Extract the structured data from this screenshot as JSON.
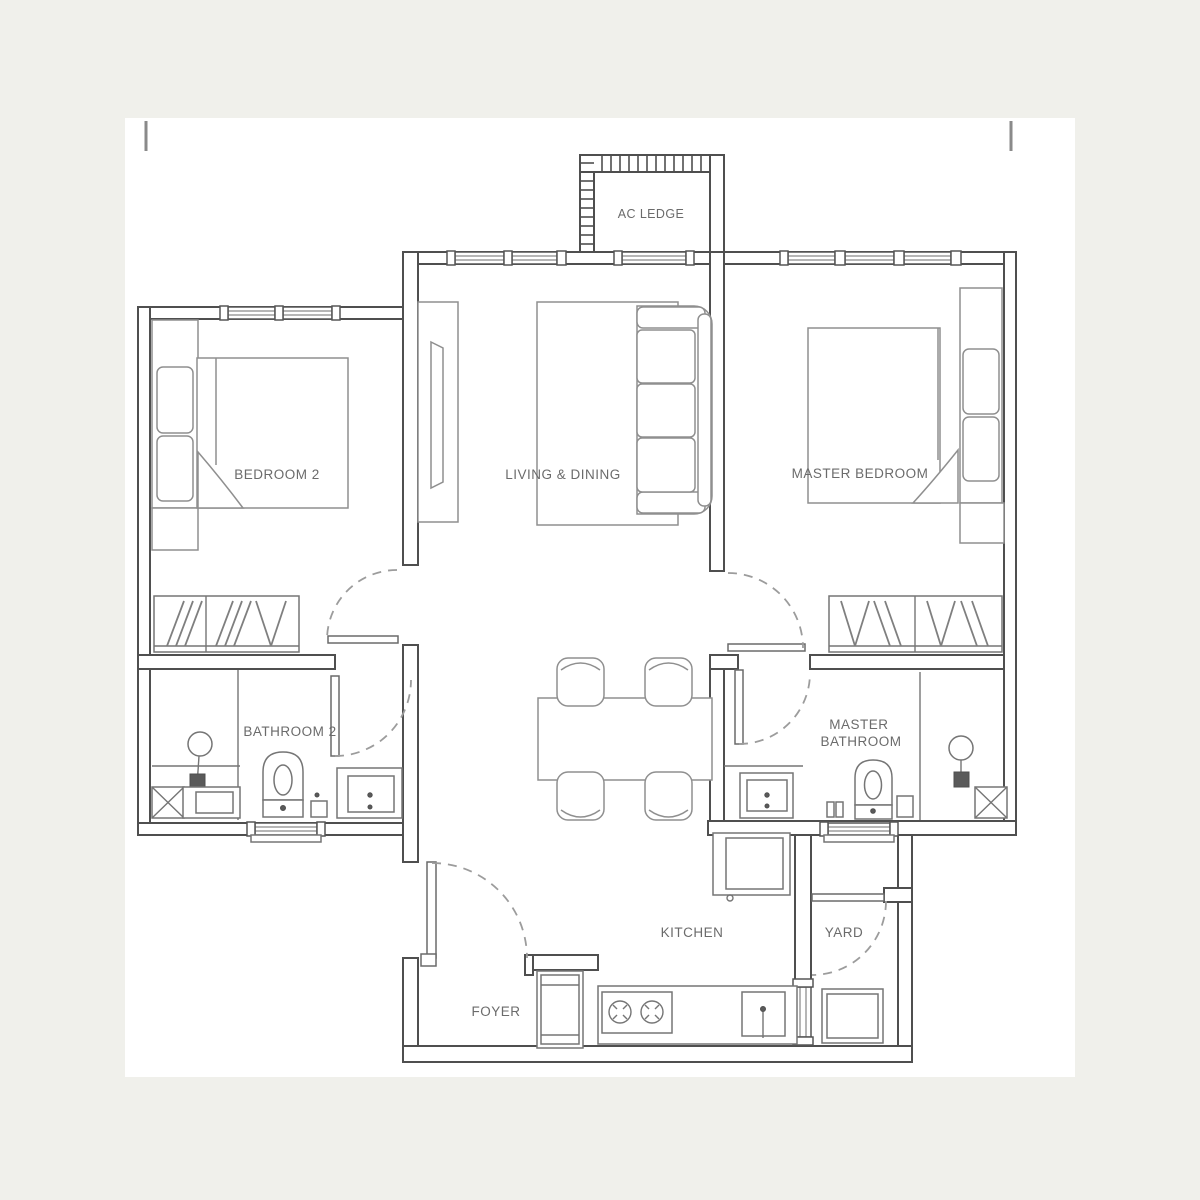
{
  "document": {
    "type": "apartment-floor-plan",
    "paper_color": "#ffffff",
    "background_color": "#f0f0eb"
  },
  "colors": {
    "wall_line": "#4f4f4f",
    "furniture_line": "#8f8f8f",
    "fixture_line": "#757575",
    "door_arc": "#9c9c9c",
    "label_text": "#6b6b6b"
  },
  "labels": {
    "ac_ledge": "AC LEDGE",
    "bedroom2": "BEDROOM 2",
    "living_dining": "LIVING & DINING",
    "master_bedroom": "MASTER BEDROOM",
    "bathroom2": "BATHROOM 2",
    "master_bathroom_line1": "MASTER",
    "master_bathroom_line2": "BATHROOM",
    "kitchen": "KITCHEN",
    "yard": "YARD",
    "foyer": "FOYER"
  },
  "rooms": [
    {
      "id": "ac-ledge",
      "label": "AC LEDGE",
      "fixtures": [
        "hatched-ledge-wall"
      ]
    },
    {
      "id": "bedroom-2",
      "label": "BEDROOM 2",
      "fixtures": [
        "double-bed-icon",
        "pillows-icon",
        "bedside-platform",
        "wardrobe-icon",
        "window",
        "swing-door"
      ]
    },
    {
      "id": "living-dining",
      "label": "LIVING & DINING",
      "fixtures": [
        "tv-console-icon",
        "rug",
        "sofa-icon",
        "dining-table-icon",
        "dining-chairs-icon",
        "windows"
      ]
    },
    {
      "id": "master-bedroom",
      "label": "MASTER BEDROOM",
      "fixtures": [
        "double-bed-icon",
        "pillows-icon",
        "bedside-platform",
        "wardrobe-icon",
        "windows",
        "swing-door"
      ]
    },
    {
      "id": "bathroom-2",
      "label": "BATHROOM 2",
      "fixtures": [
        "shower-icon",
        "floor-trap-icon",
        "toilet-icon",
        "vanity-icon",
        "swing-door",
        "window"
      ]
    },
    {
      "id": "master-bathroom",
      "label": "MASTER BATHROOM",
      "fixtures": [
        "vanity-icon",
        "toilet-icon",
        "shower-icon",
        "floor-trap-icon",
        "swing-door",
        "window"
      ]
    },
    {
      "id": "kitchen",
      "label": "KITCHEN",
      "fixtures": [
        "counter",
        "hob-icon",
        "sink-icon",
        "fridge-icon"
      ]
    },
    {
      "id": "yard",
      "label": "YARD",
      "fixtures": [
        "washing-machine-icon",
        "swing-door",
        "window"
      ]
    },
    {
      "id": "foyer",
      "label": "FOYER",
      "fixtures": [
        "shoe-cabinet-icon",
        "entrance-swing-door"
      ]
    }
  ]
}
